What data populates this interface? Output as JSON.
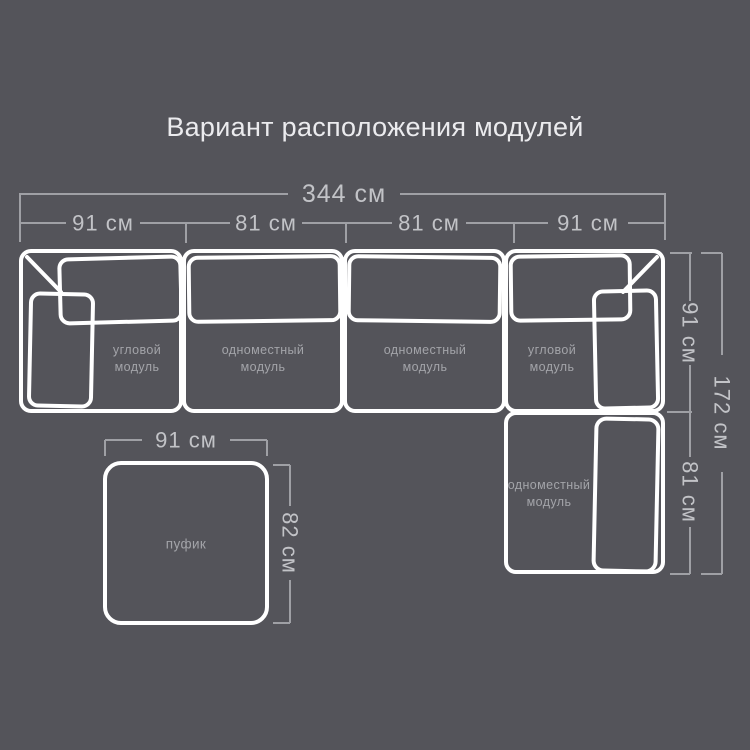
{
  "title": "Вариант расположения модулей",
  "dimensions": {
    "total": "344 см",
    "segments": [
      "91 см",
      "81 см",
      "81 см",
      "91 см"
    ],
    "right": {
      "top": "91 см",
      "overall": "172 см",
      "bottom": "81 см"
    },
    "pouf": {
      "width": "91 см",
      "depth": "82 см"
    }
  },
  "modules": [
    {
      "name": "corner-left",
      "label": [
        "угловой",
        "модуль"
      ]
    },
    {
      "name": "single-1",
      "label": [
        "одноместный",
        "модуль"
      ]
    },
    {
      "name": "single-2",
      "label": [
        "одноместный",
        "модуль"
      ]
    },
    {
      "name": "corner-right",
      "label": [
        "угловой",
        "модуль"
      ]
    },
    {
      "name": "single-bottom",
      "label": [
        "одноместный",
        "модуль"
      ]
    }
  ],
  "pouf": {
    "label": "пуфик"
  },
  "colors": {
    "background": "#54545a",
    "sofa_outline": "#ffffff",
    "dimension_lines": "#9fa0a5",
    "dimension_text": "#c2c3c7",
    "module_label_text": "#a3a4a9",
    "title_text": "#ebebee"
  }
}
